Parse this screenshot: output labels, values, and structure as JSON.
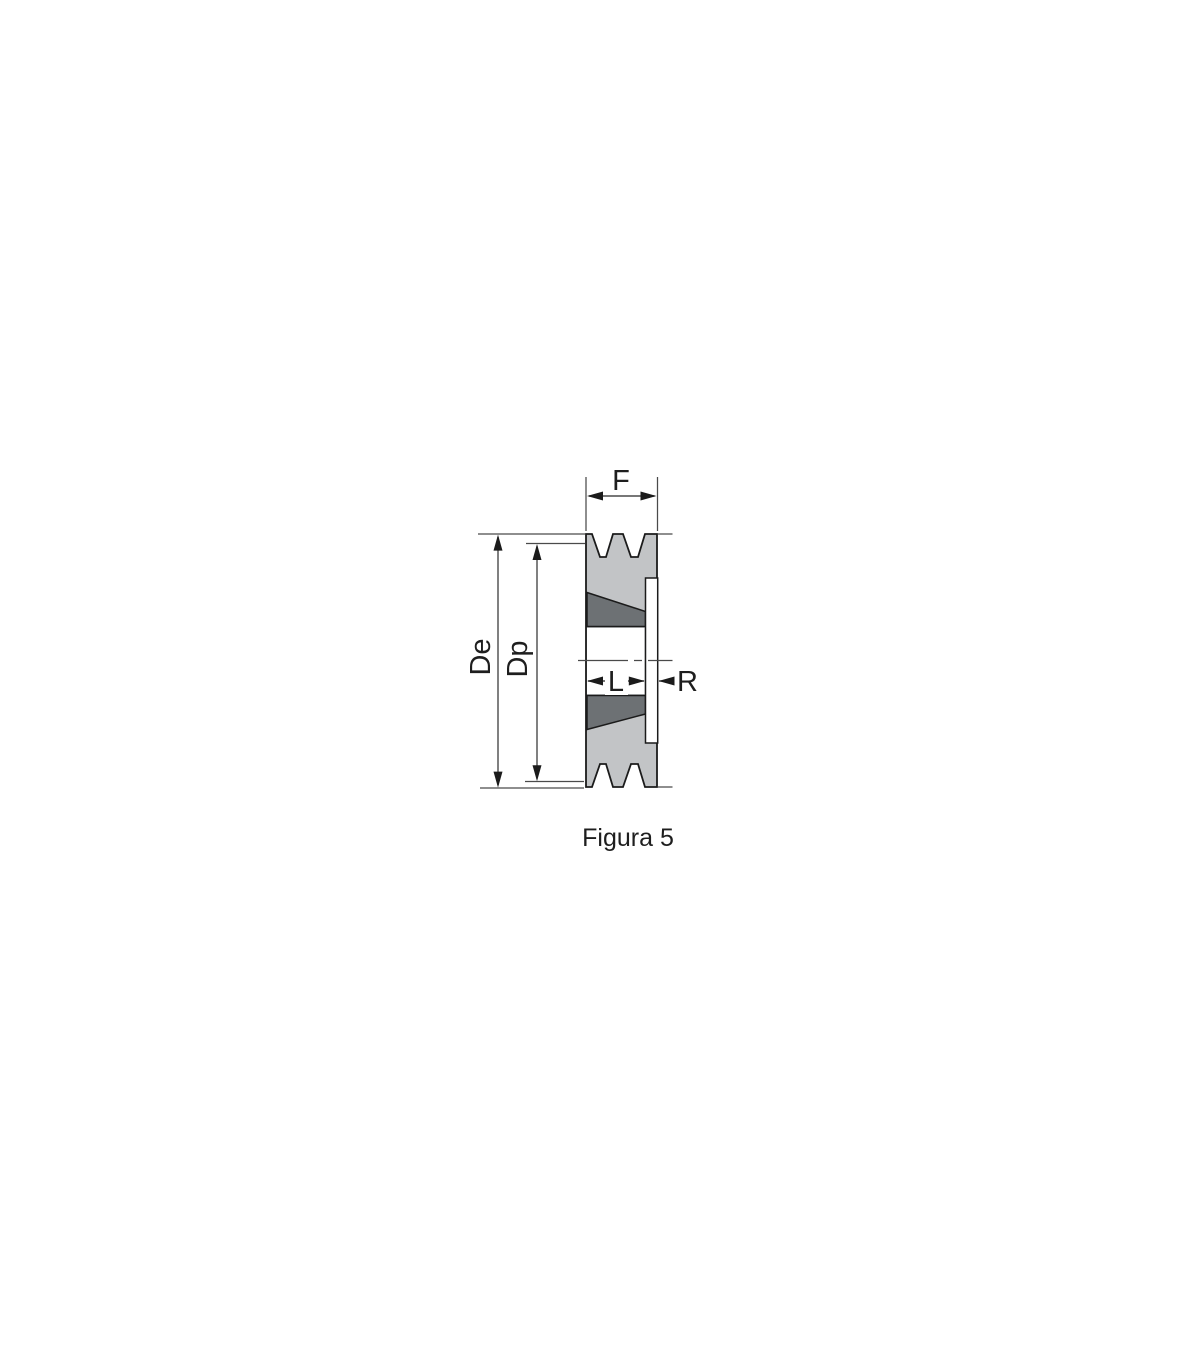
{
  "figure": {
    "caption": "Figura 5",
    "labels": {
      "face_width": "F",
      "outer_diameter": "De",
      "pitch_diameter": "Dp",
      "bushing_length": "L",
      "flange_offset": "R"
    }
  },
  "colors": {
    "page-bg": "#ffffff",
    "body-gray": "#c2c4c6",
    "taper-dark": "#6d7174",
    "outline": "#1b1b1b",
    "dim-line": "#4a4a4a",
    "text": "#1e1e1e"
  }
}
